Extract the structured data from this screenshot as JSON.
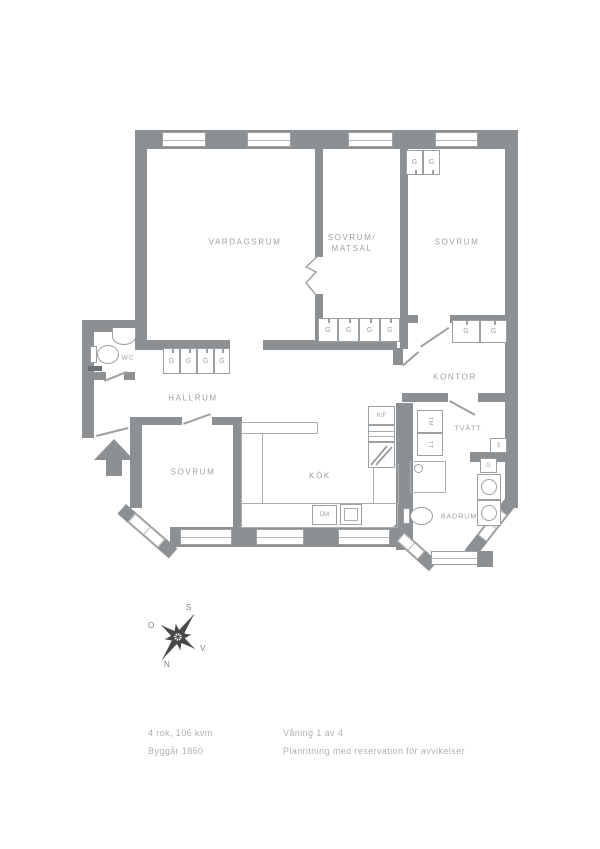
{
  "plan": {
    "rooms": {
      "living": "VARDAGSRUM",
      "bed_dining_line1": "SOVRUM/",
      "bed_dining_line2": "MATSAL",
      "bedroom_right": "SOVRUM",
      "wc": "WC",
      "hall": "HALLRUM",
      "office": "KONTOR",
      "bedroom_bottom": "SOVRUM",
      "kitchen": "KÖK",
      "laundry": "TVÄTT",
      "bathroom": "BADRUM"
    },
    "fixtures": {
      "wardrobe": "G",
      "cabinet": "S",
      "fridge_freezer": "K/F",
      "dishwasher": "DM",
      "washer": "TM",
      "dryer": "TT"
    },
    "compass": {
      "north": "N",
      "south": "S",
      "east": "O",
      "west": "V"
    }
  },
  "footer": {
    "size": "4 rok, 106 kvm",
    "built": "Byggår 1850",
    "floor": "Våning 1 av 4",
    "disclaimer": "Planritning med reservation för avvikelser"
  },
  "colors": {
    "wall": "#8d9093",
    "line": "#9aa0a3",
    "label": "#9ca0a3",
    "footer_text": "#aeb1b4"
  }
}
